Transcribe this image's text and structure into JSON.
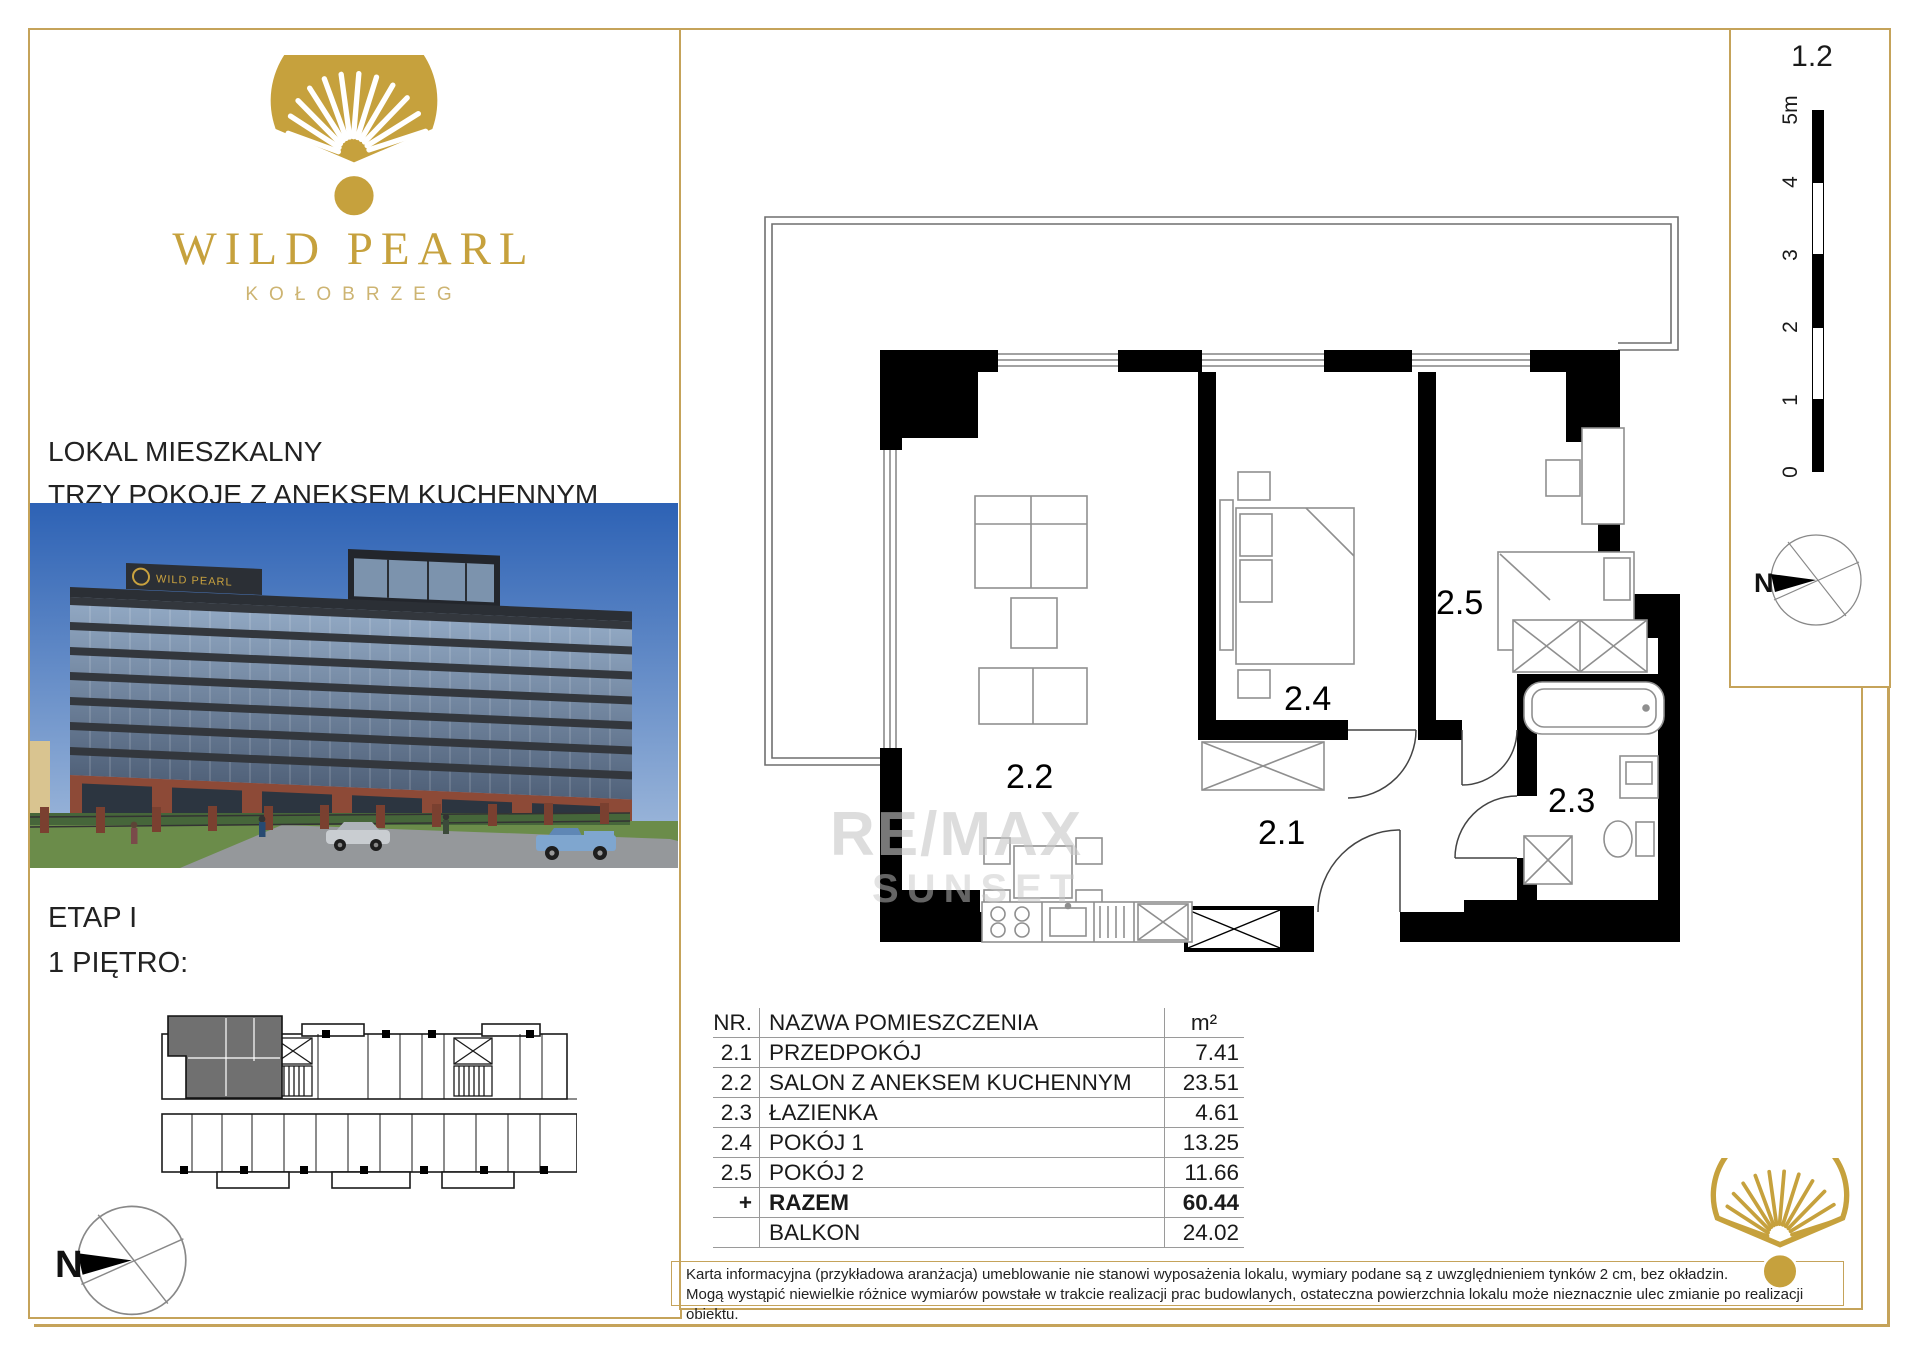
{
  "brand": {
    "title": "WILD PEARL",
    "city": "KOŁOBRZEG",
    "gold": "#c6a13d",
    "border_gold": "#c5a35a"
  },
  "left_panel": {
    "type_line1": "LOKAL MIESZKALNY",
    "type_line2": "TRZY POKOJE Z ANEKSEM KUCHENNYM",
    "etap": "ETAP I",
    "floor": "1 PIĘTRO:",
    "compass_label": "N",
    "photo_sign": "WILD PEARL"
  },
  "plan": {
    "number": "1.2",
    "compass_label": "N",
    "watermark1": "RE/MAX",
    "watermark2": "SUNSET",
    "rooms": {
      "r21": "2.1",
      "r22": "2.2",
      "r23": "2.3",
      "r24": "2.4",
      "r25": "2.5"
    },
    "scale_ticks": [
      "5m",
      "4",
      "3",
      "2",
      "1",
      "0"
    ]
  },
  "table": {
    "header": {
      "nr": "NR.",
      "name": "NAZWA POMIESZCZENIA",
      "area": "m²"
    },
    "rows": [
      {
        "nr": "2.1",
        "name": "PRZEDPOKÓJ",
        "area": "7.41"
      },
      {
        "nr": "2.2",
        "name": "SALON Z ANEKSEM KUCHENNYM",
        "area": "23.51"
      },
      {
        "nr": "2.3",
        "name": "ŁAZIENKA",
        "area": "4.61"
      },
      {
        "nr": "2.4",
        "name": "POKÓJ 1",
        "area": "13.25"
      },
      {
        "nr": "2.5",
        "name": "POKÓJ 2",
        "area": "11.66"
      }
    ],
    "total": {
      "nr": "+",
      "name": "RAZEM",
      "area": "60.44"
    },
    "balcony": {
      "nr": "",
      "name": "BALKON",
      "area": "24.02"
    }
  },
  "disclaimer": {
    "line1": "Karta informacyjna (przykładowa aranżacja) umeblowanie nie stanowi wyposażenia lokalu, wymiary podane są z uwzględnieniem tynków 2 cm, bez okładzin.",
    "line2": "Mogą wystąpić niewielkie różnice wymiarów powstałe w trakcie realizacji prac budowlanych, ostateczna powierzchnia lokalu może nieznacznie ulec zmianie po realizacji obiektu."
  }
}
